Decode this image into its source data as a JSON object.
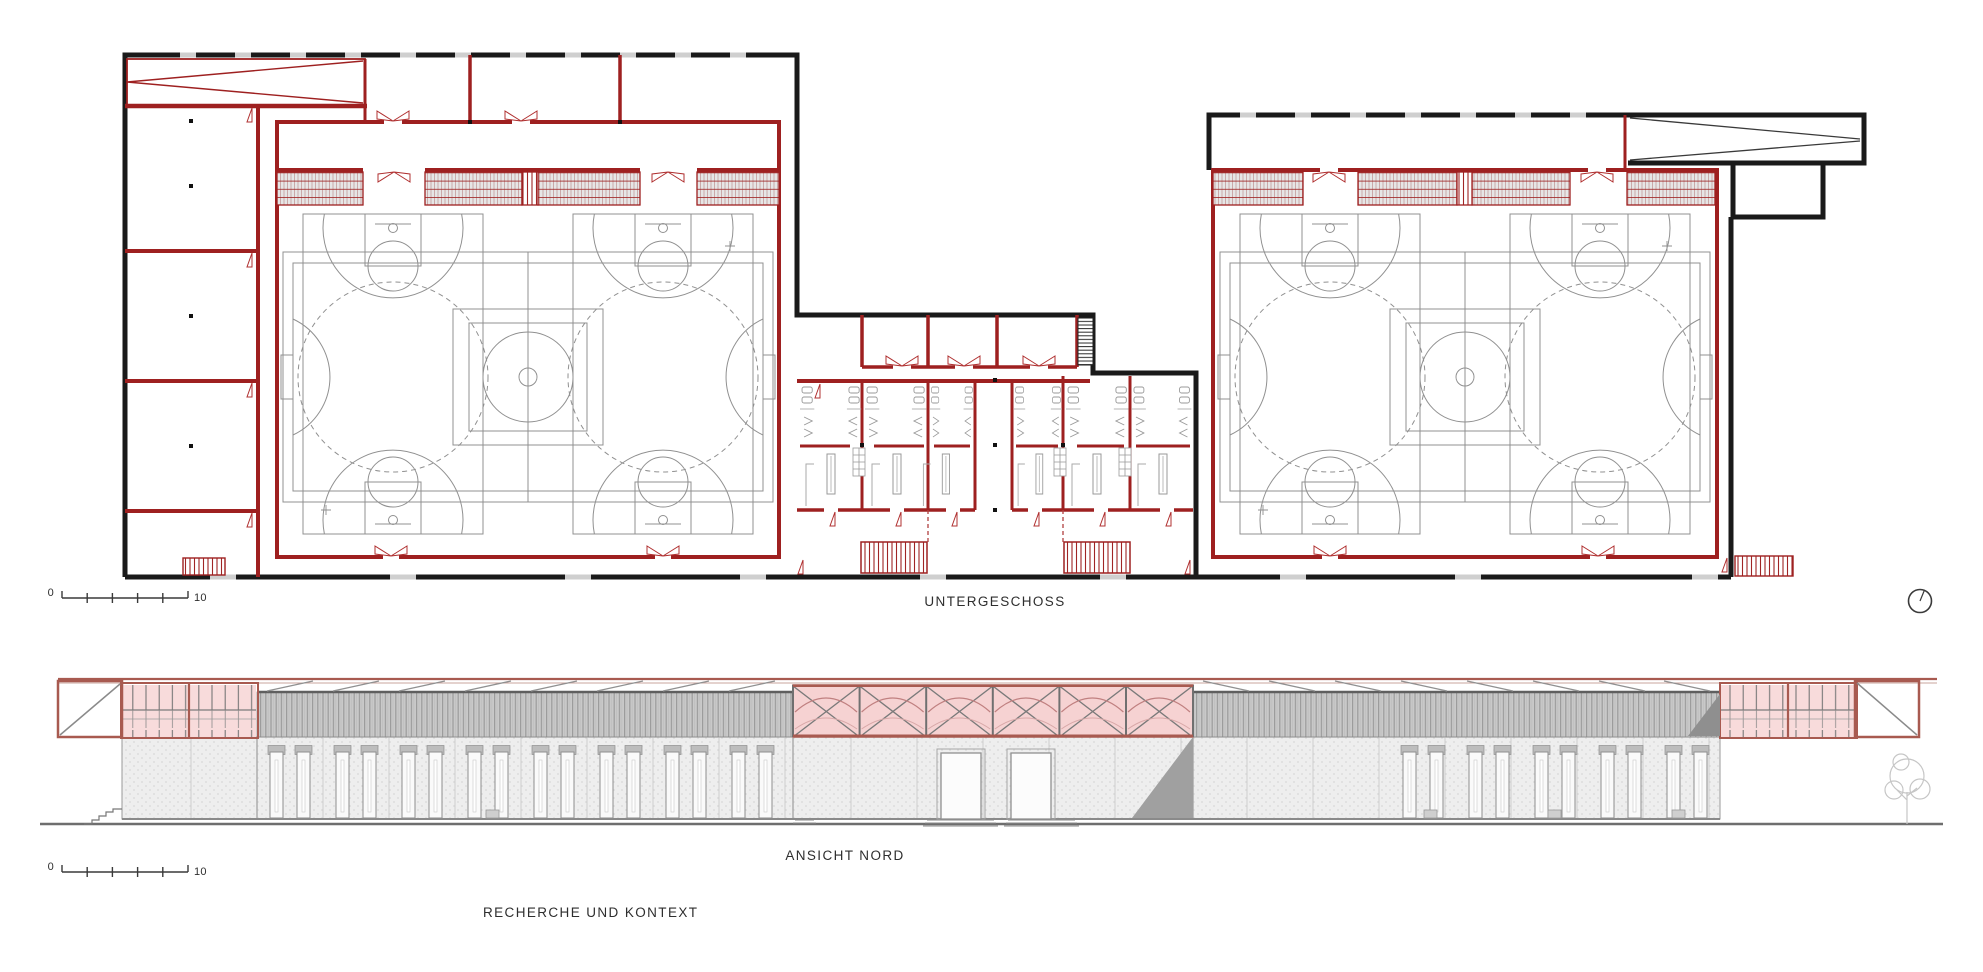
{
  "document": {
    "type": "architectural-sheet",
    "background": "#ffffff"
  },
  "palette": {
    "wall_black": "#1a1a1a",
    "wall_red": "#9e2020",
    "door_red": "#b03030",
    "court_gray": "#909090",
    "frame_brown": "#a85a50",
    "glazing_pink": "#f8dbdb",
    "vault_pink": "#c08080",
    "corrugation_gray": "#c9c9c9",
    "stipple_wall": "#eeeeee",
    "shadow_gray": "#a0a0a0",
    "ground_gray": "#6e6e6e",
    "text_color": "#2e2e2e"
  },
  "plan": {
    "title": "UNTERGESCHOSS",
    "scale_bar": {
      "start_label": "0",
      "end_label": "10"
    }
  },
  "elevation": {
    "title": "ANSICHT NORD",
    "scale_bar": {
      "start_label": "0",
      "end_label": "10"
    }
  },
  "footer": {
    "title": "RECHERCHE UND KONTEXT"
  },
  "north_indicator": {
    "icon": "north-arrow-icon"
  }
}
